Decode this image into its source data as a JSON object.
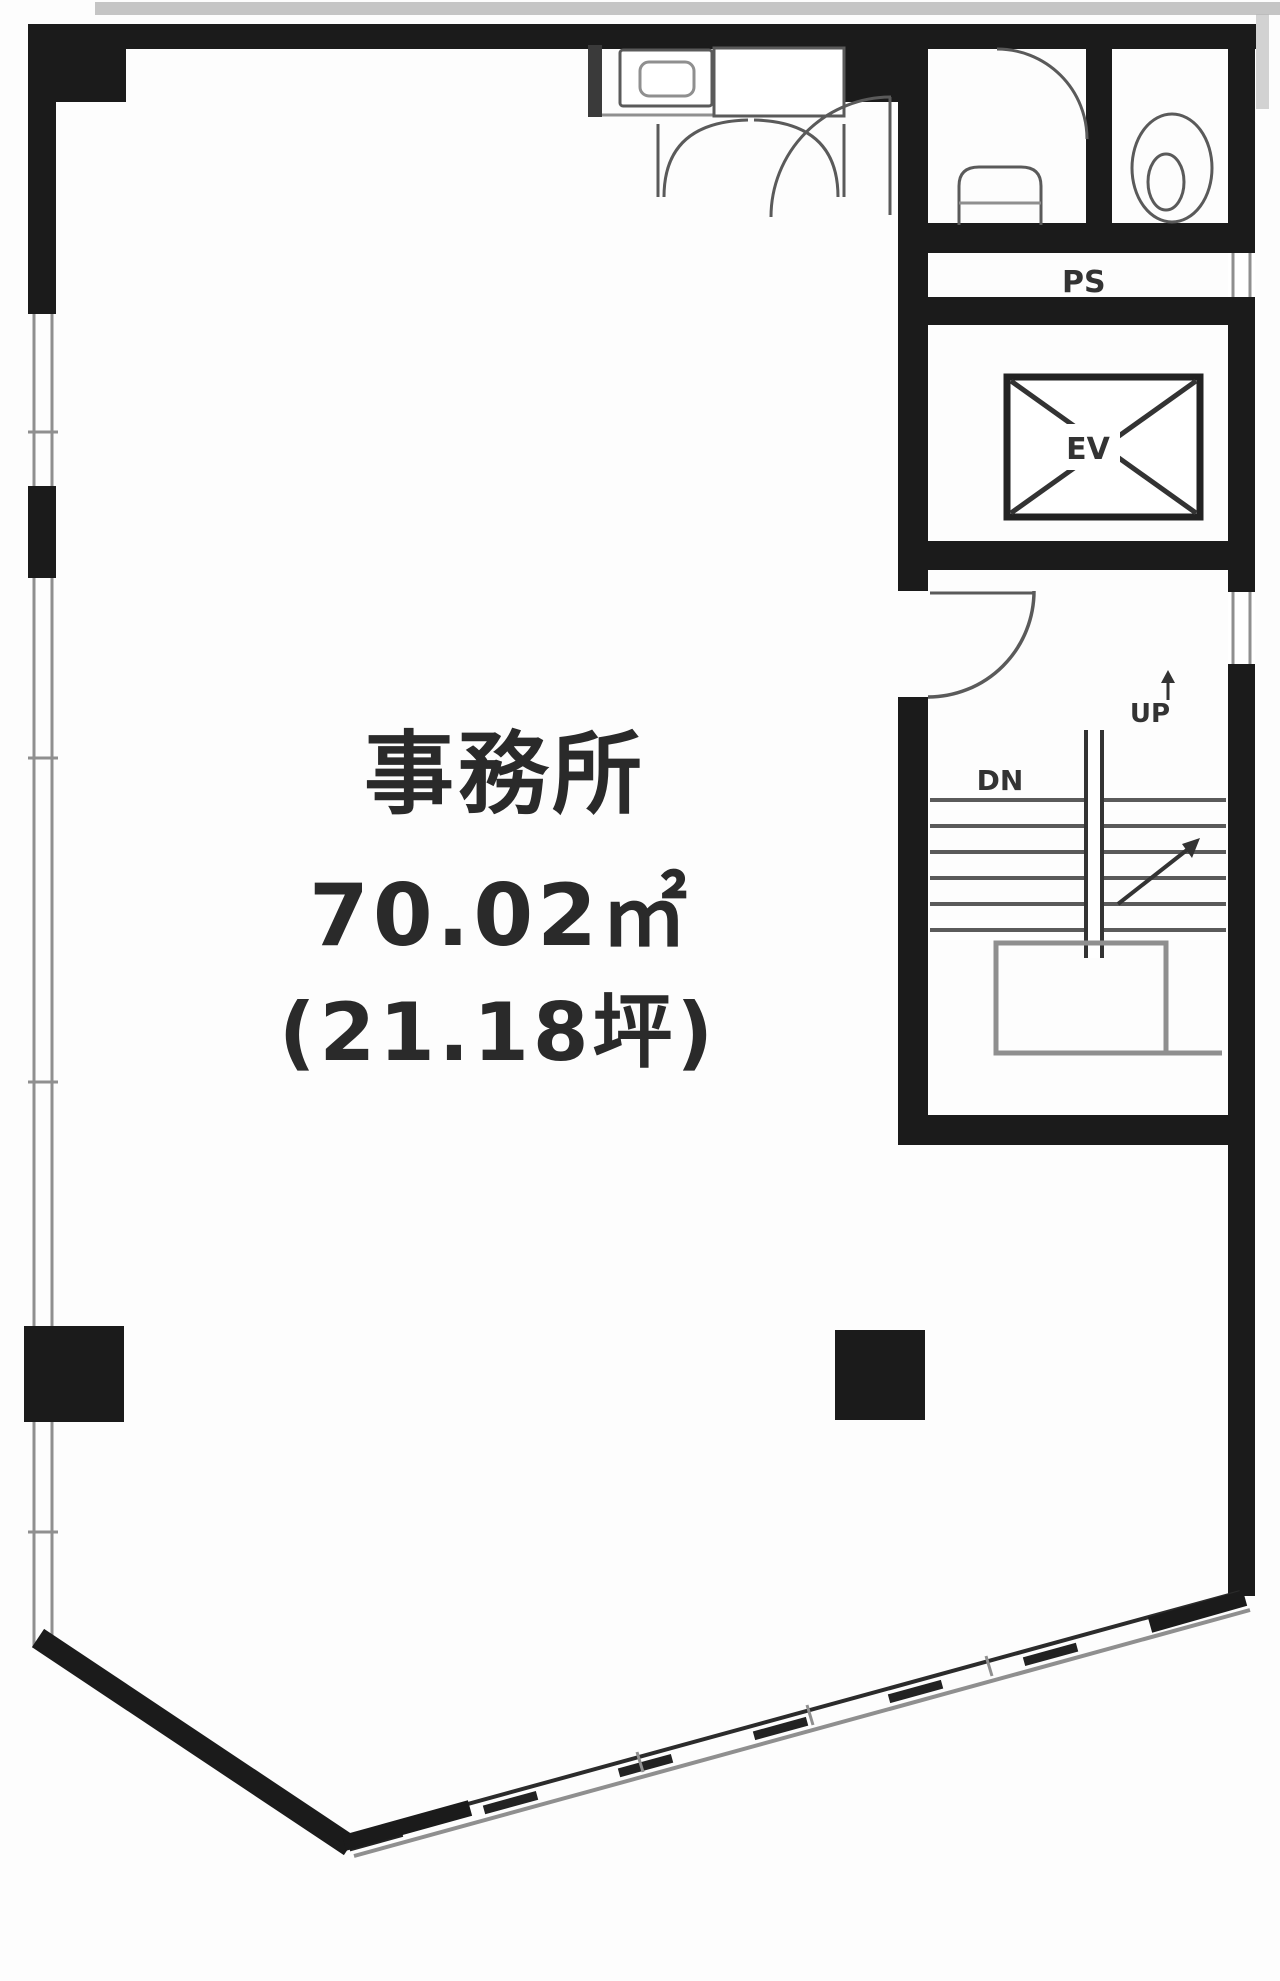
{
  "plan": {
    "type": "floor-plan",
    "labels": {
      "room_name": "事務所",
      "area_m2": "70.02㎡",
      "area_tsubo": "(21.18坪)",
      "elevator": "EV",
      "pipe_shaft": "PS",
      "stairs_up": "UP",
      "stairs_down": "DN"
    }
  },
  "colors": {
    "wall": "#1b1b1b",
    "line-mid": "#5a5a5a",
    "line-light": "#8f8f8f",
    "text": "#2a2a2a",
    "bg": "#fdfdfd"
  }
}
